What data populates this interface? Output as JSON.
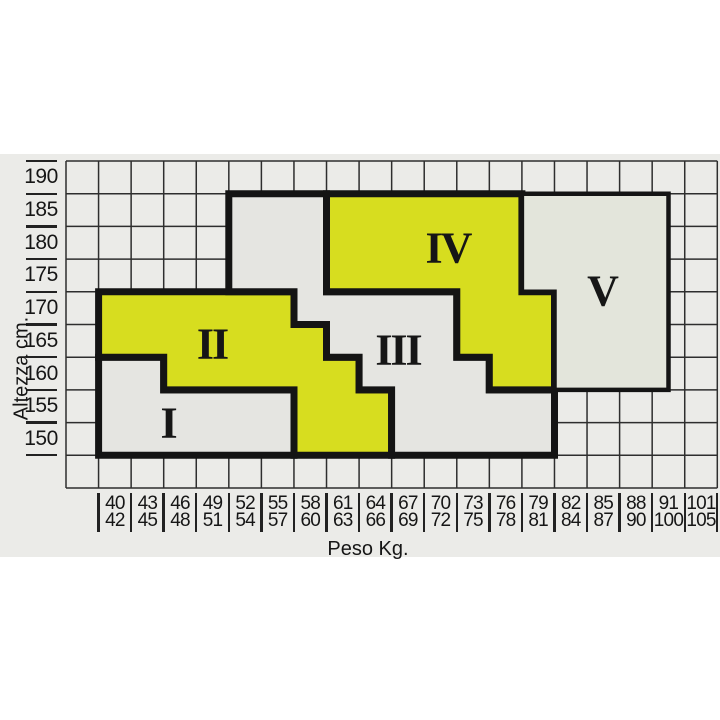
{
  "band": {
    "top": 154,
    "bottom": 557
  },
  "axes": {
    "x_title": "Peso Kg.",
    "y_title": "Altezza cm.",
    "y_labels": [
      "190",
      "185",
      "180",
      "175",
      "170",
      "165",
      "160",
      "155",
      "150"
    ],
    "x_labels": [
      [
        "40",
        "42"
      ],
      [
        "43",
        "45"
      ],
      [
        "46",
        "48"
      ],
      [
        "49",
        "51"
      ],
      [
        "52",
        "54"
      ],
      [
        "55",
        "57"
      ],
      [
        "58",
        "60"
      ],
      [
        "61",
        "63"
      ],
      [
        "64",
        "66"
      ],
      [
        "67",
        "69"
      ],
      [
        "70",
        "72"
      ],
      [
        "73",
        "75"
      ],
      [
        "76",
        "78"
      ],
      [
        "79",
        "81"
      ],
      [
        "82",
        "84"
      ],
      [
        "85",
        "87"
      ],
      [
        "88",
        "90"
      ],
      [
        "91",
        "100"
      ],
      [
        "101",
        "105"
      ]
    ]
  },
  "chart_data": {
    "type": "heatmap",
    "title": "Size zones by weight and height",
    "xlabel": "Peso Kg.",
    "ylabel": "Altezza cm.",
    "x_categories": [
      "40-42",
      "43-45",
      "46-48",
      "49-51",
      "52-54",
      "55-57",
      "58-60",
      "61-63",
      "64-66",
      "67-69",
      "70-72",
      "73-75",
      "76-78",
      "79-81",
      "82-84",
      "85-87",
      "88-90",
      "91-100",
      "101-105"
    ],
    "y_categories": [
      190,
      185,
      180,
      175,
      170,
      165,
      160,
      155,
      150
    ],
    "grid": "on",
    "geometry": {
      "left": 66,
      "right": 717.3,
      "top": 161,
      "bottom": 488,
      "cols": 20,
      "rows": 10,
      "x_label_top": 492,
      "x_label_height": 41,
      "band_color": "#ebebe8"
    },
    "colors": {
      "zone_yellow": "#d7dd1f",
      "zone_gray": "#e5e5e1",
      "zone_gray_v": "#e3e5db",
      "grid_line": "#2e2e2e",
      "border_black": "#141414",
      "text": "#161616"
    },
    "regions": [
      {
        "label": "I",
        "fill": "#e5e5e1",
        "stroke_width": 7,
        "outline_grid": [
          [
            1,
            6
          ],
          [
            3,
            6
          ],
          [
            3,
            7
          ],
          [
            7,
            7
          ],
          [
            7,
            9
          ],
          [
            1,
            9
          ]
        ],
        "label_px": [
          168,
          423
        ],
        "coverage": {
          "height_150-155": "weight 40-57",
          "height_160": "weight 40-45"
        }
      },
      {
        "label": "II",
        "fill": "#d7dd1f",
        "stroke_width": 7,
        "outline_grid": [
          [
            1,
            4
          ],
          [
            7,
            4
          ],
          [
            7,
            5
          ],
          [
            8,
            5
          ],
          [
            8,
            6
          ],
          [
            9,
            6
          ],
          [
            9,
            7
          ],
          [
            10,
            7
          ],
          [
            10,
            9
          ],
          [
            7,
            9
          ],
          [
            7,
            7
          ],
          [
            3,
            7
          ],
          [
            3,
            6
          ],
          [
            1,
            6
          ]
        ],
        "label_px": [
          212,
          344
        ],
        "coverage": {
          "height_150-155": "weight 58-66",
          "height_160": "weight 46-63",
          "height_165": "weight 40-60",
          "height_170": "weight 40-57"
        }
      },
      {
        "label": "III",
        "fill": "#e5e5e1",
        "stroke_width": 7,
        "outline_grid": [
          [
            5,
            1
          ],
          [
            8,
            1
          ],
          [
            8,
            4
          ],
          [
            12,
            4
          ],
          [
            12,
            6
          ],
          [
            13,
            6
          ],
          [
            13,
            7
          ],
          [
            15,
            7
          ],
          [
            15,
            9
          ],
          [
            10,
            9
          ],
          [
            10,
            7
          ],
          [
            9,
            7
          ],
          [
            9,
            6
          ],
          [
            8,
            6
          ],
          [
            8,
            5
          ],
          [
            7,
            5
          ],
          [
            7,
            4
          ],
          [
            5,
            4
          ]
        ],
        "label_px": [
          398,
          350
        ],
        "coverage": {
          "height_150-155": "weight 67-81",
          "height_160": "weight 64-75",
          "height_165": "weight 61-72",
          "height_170": "weight 58-72",
          "height_175-185": "weight 52-60"
        }
      },
      {
        "label": "IV",
        "fill": "#d7dd1f",
        "stroke_width": 7,
        "outline_grid": [
          [
            8,
            1
          ],
          [
            14,
            1
          ],
          [
            14,
            4
          ],
          [
            15,
            4
          ],
          [
            15,
            7
          ],
          [
            13,
            7
          ],
          [
            13,
            6
          ],
          [
            12,
            6
          ],
          [
            12,
            4
          ],
          [
            8,
            4
          ]
        ],
        "label_px": [
          448,
          248
        ],
        "coverage": {
          "height_160": "weight 76-81",
          "height_165-170": "weight 73-81",
          "height_175-185": "weight 61-78"
        }
      },
      {
        "label": "V",
        "fill": "#e3e5db",
        "stroke_width": 4.5,
        "outline_grid": [
          [
            14,
            1
          ],
          [
            18.5,
            1
          ],
          [
            18.5,
            7
          ],
          [
            15,
            7
          ],
          [
            15,
            4
          ],
          [
            14,
            4
          ]
        ],
        "label_px": [
          602,
          291
        ],
        "coverage": {
          "height_160-170": "weight 82-100",
          "height_175-185": "weight 79-100"
        }
      }
    ]
  }
}
